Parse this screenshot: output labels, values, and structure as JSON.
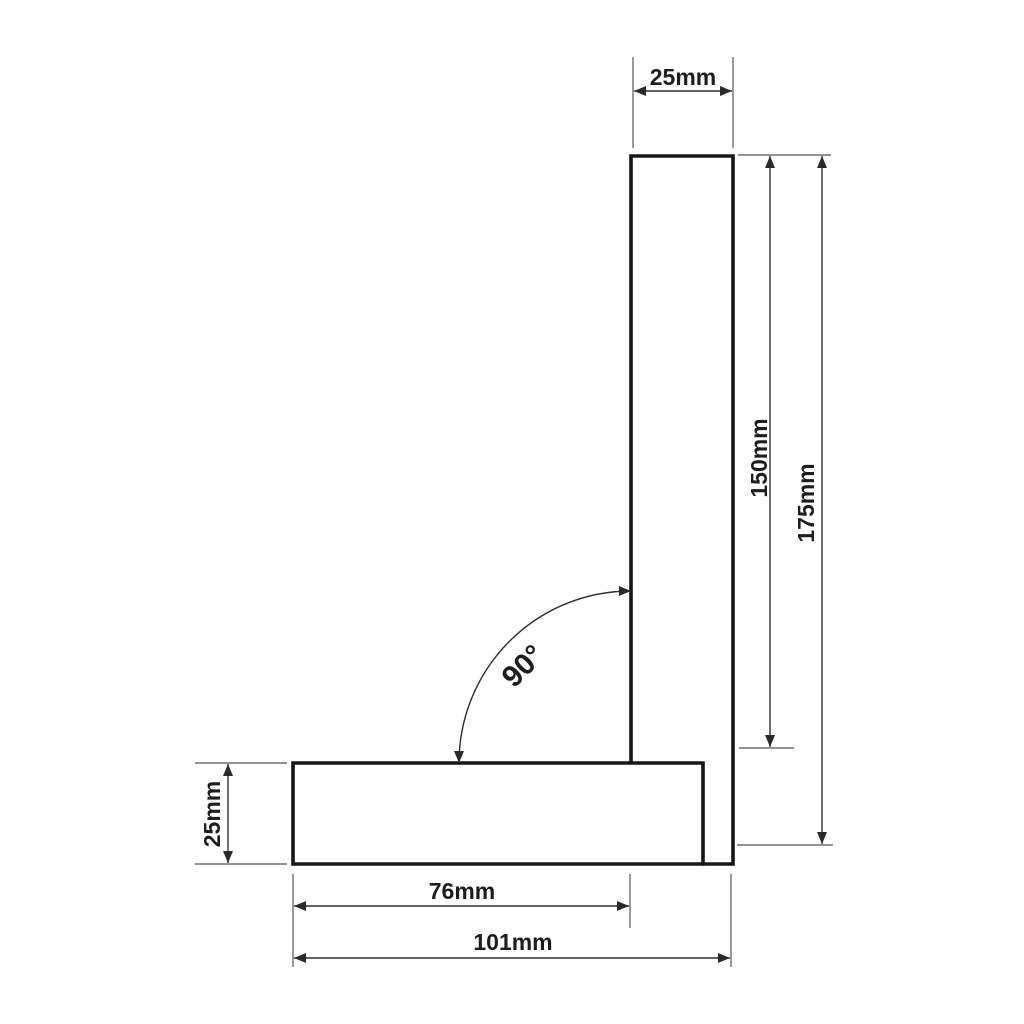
{
  "diagram": {
    "type": "technical-dimension-drawing",
    "subject": "try-square (L-shaped engineer square), front view with dimension callouts",
    "background_color": "#ffffff",
    "colors": {
      "shape_outline": "#161616",
      "dimension_line": "#2f2f2f",
      "extension_line": "#6e6e6e",
      "label_text": "#1d1d1d"
    },
    "dimensions": {
      "blade_width": {
        "label": "25mm",
        "orientation": "horizontal",
        "position": "top"
      },
      "blade_length": {
        "label": "150mm",
        "orientation": "vertical",
        "position": "right-inner"
      },
      "overall_height": {
        "label": "175mm",
        "orientation": "vertical",
        "position": "right-outer"
      },
      "base_thickness": {
        "label": "25mm",
        "orientation": "vertical",
        "position": "left"
      },
      "base_inner_length": {
        "label": "76mm",
        "orientation": "horizontal",
        "position": "bottom-inner"
      },
      "base_overall_length": {
        "label": "101mm",
        "orientation": "horizontal",
        "position": "bottom-outer"
      },
      "angle": {
        "label": "90°",
        "orientation": "diagonal",
        "position": "inner-corner-arc"
      }
    }
  }
}
